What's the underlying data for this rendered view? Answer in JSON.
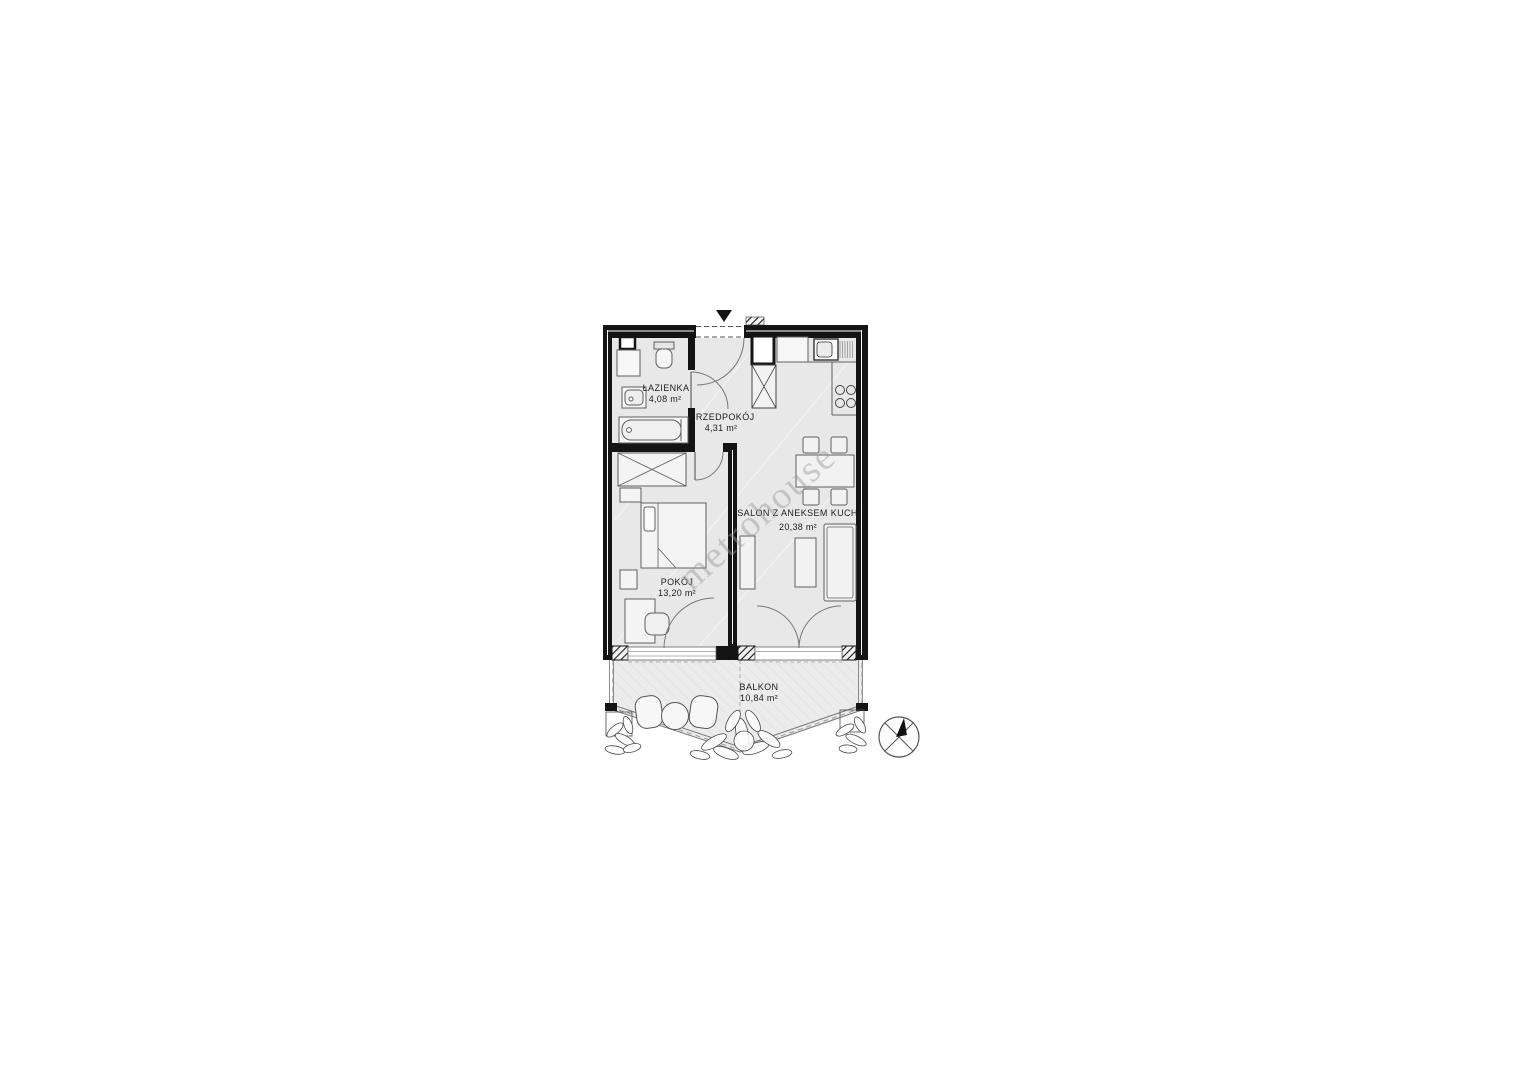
{
  "watermark": "metrohouse",
  "plan": {
    "rooms": [
      {
        "name": "ŁAZIENKA",
        "area": "4,08 m²"
      },
      {
        "name": "PRZEDPOKÓJ",
        "area": "4,31 m²"
      },
      {
        "name": "POKÓJ",
        "area": "13,20 m²"
      },
      {
        "name": "SALON Z ANEKSEM KUCH.",
        "area": "20,38 m²"
      },
      {
        "name": "BALKON",
        "area": "10,84 m²"
      }
    ],
    "colors": {
      "wall": "#141414",
      "floor": "#e8e8e8",
      "balcony_floor": "#ececec",
      "furniture_stroke": "#5f5f5f",
      "label_text": "#1c1c1c",
      "watermark": "#969696"
    }
  }
}
